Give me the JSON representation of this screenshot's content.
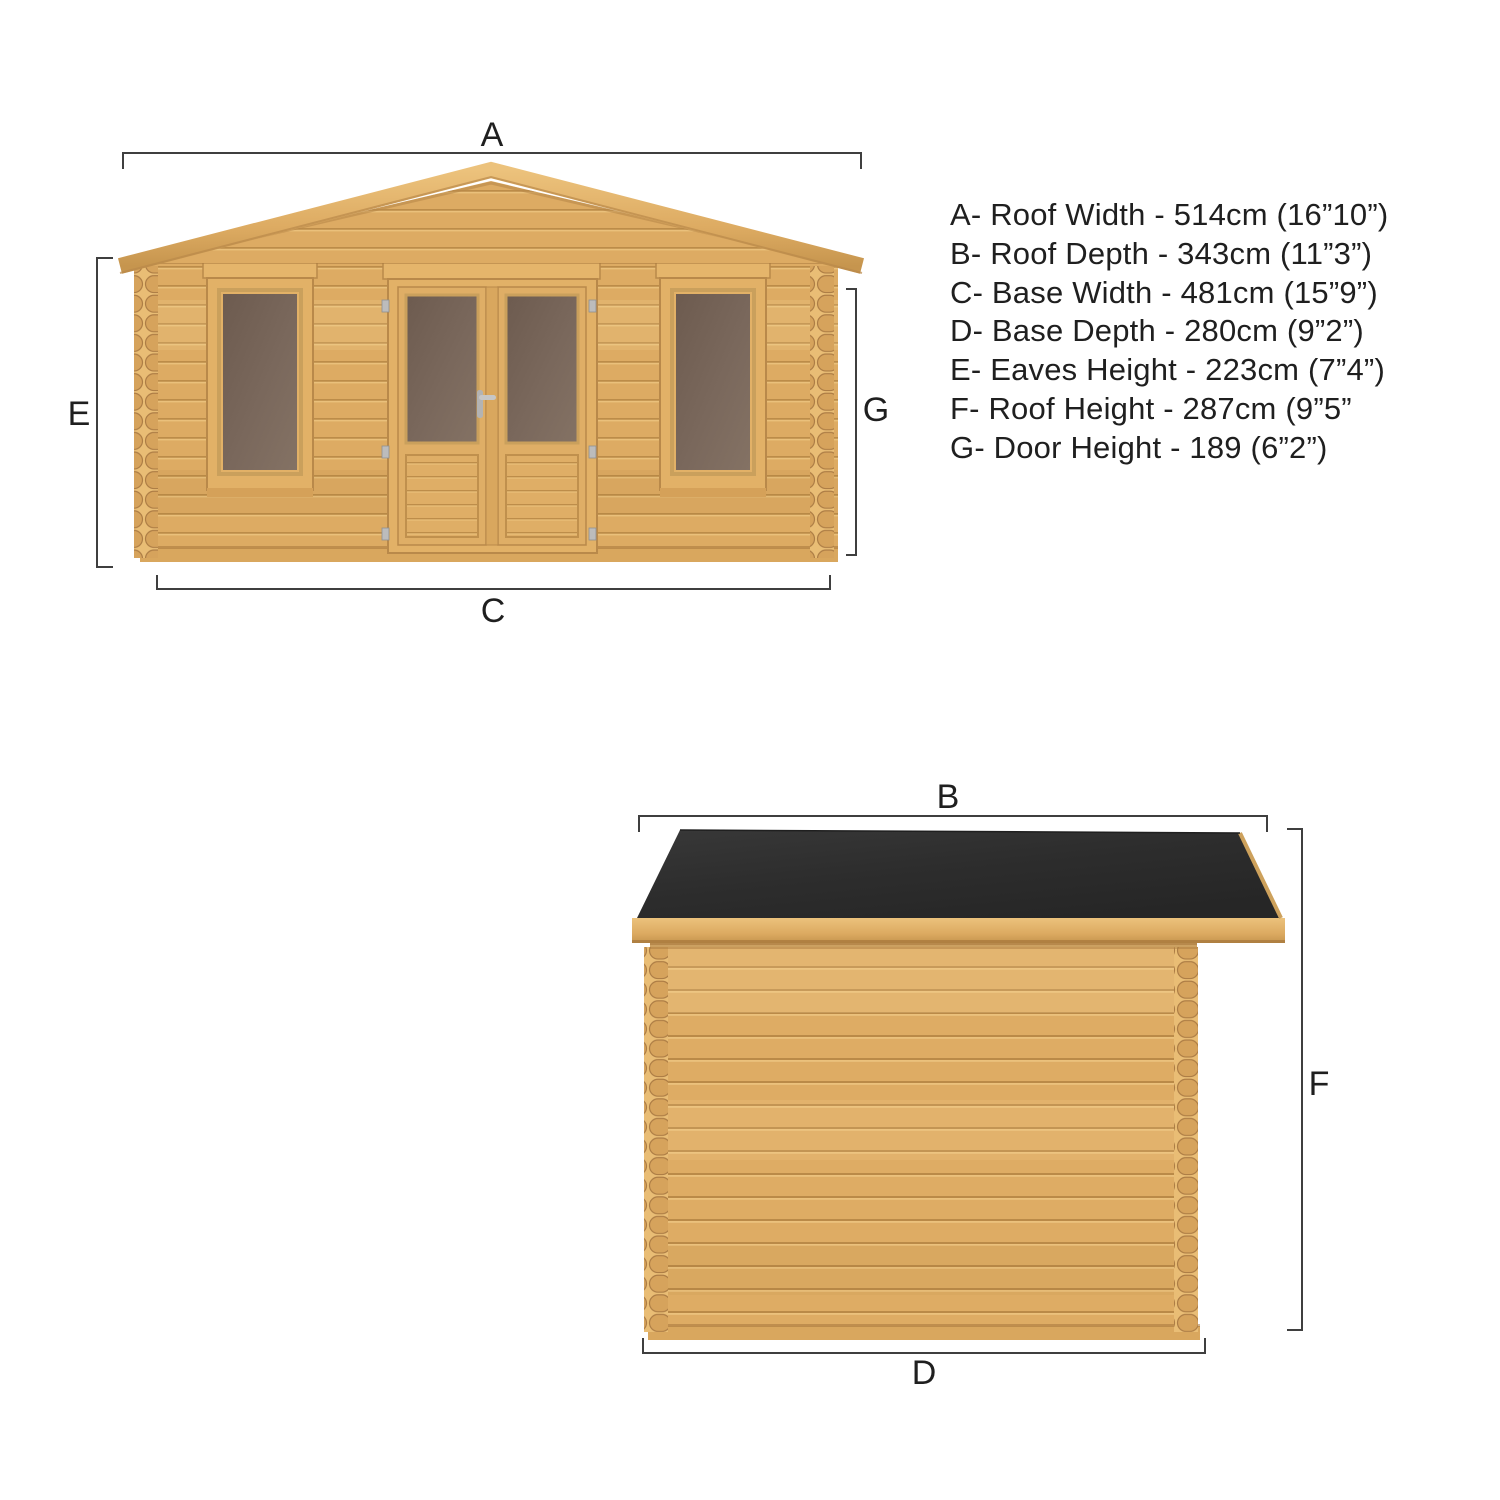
{
  "views": {
    "front": {
      "description": "front elevation of log cabin with apex roof, double glazed doors and two windows",
      "dim_labels": {
        "top": "A",
        "left": "E",
        "right": "G",
        "bottom": "C"
      }
    },
    "side": {
      "description": "side elevation of log cabin with dark felt roof overhanging to the right",
      "dim_labels": {
        "top": "B",
        "right": "F",
        "bottom": "D"
      }
    }
  },
  "specs": {
    "lines": [
      "A- Roof Width - 514cm (16”10”)",
      "B- Roof Depth - 343cm (11”3”)",
      "C- Base Width - 481cm (15”9”)",
      "D- Base Depth - 280cm (9”2”)",
      "E- Eaves Height - 223cm (7”4”)",
      "F- Roof Height - 287cm (9”5”",
      "G- Door Height - 189 (6”2”)"
    ]
  },
  "colors": {
    "background": "#ffffff",
    "wood_base": "#ddab63",
    "wood_dark": "#bc8c49",
    "wood_light": "#edc47f",
    "fascia": "#e2b167",
    "glass": "#76655a",
    "roof_felt": "#2e2e2e",
    "dimension_line": "#3f3f3f",
    "text": "#1f1f1f",
    "hardware_silver": "#bcbcbc"
  }
}
